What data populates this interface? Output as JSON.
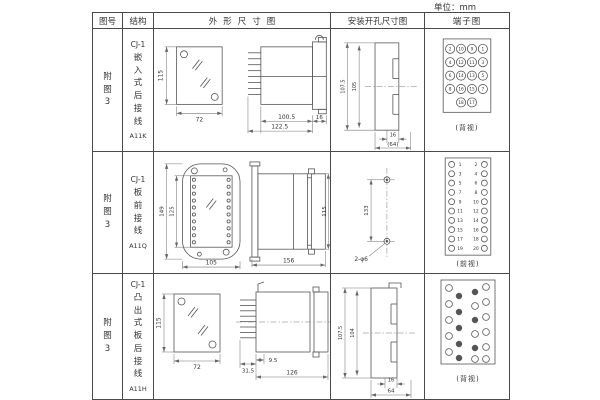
{
  "unit_label": "单位：mm",
  "headers": {
    "fig_no": "图号",
    "structure": "结构",
    "outline": "外形尺寸图",
    "mounting": "安装开孔尺寸图",
    "terminal": "端子图"
  },
  "rows": [
    {
      "fig_no": "附图3",
      "structure_title": "CJ-1",
      "structure_name": "嵌入式后接线",
      "model": "A11K",
      "outline": {
        "front_h": "115",
        "front_w": "72",
        "body_len": "100.5",
        "total_len": "122.5",
        "flange_w": "16"
      },
      "mounting": {
        "outer_h": "107.5",
        "inner_h": "105",
        "slot_w": "16",
        "width": "(64)"
      },
      "terminal": {
        "caption": "(背视)",
        "grid": [
          [
            "2",
            "10",
            "9",
            "1"
          ],
          [
            "4",
            "12",
            "11",
            "3"
          ],
          [
            "6",
            "14",
            "13",
            "5"
          ],
          [
            "8",
            "16",
            "15",
            "7"
          ]
        ],
        "bottom": [
          "18",
          "17"
        ]
      }
    },
    {
      "fig_no": "附图3",
      "structure_title": "CJ-1",
      "structure_name": "板前接线",
      "model": "A11Q",
      "outline": {
        "outer_h": "149",
        "inner_h": "125",
        "front_w": "105",
        "body_len": "156",
        "body_h": "115"
      },
      "mounting": {
        "hole_spacing": "133",
        "holes_label": "2-φ6"
      },
      "terminal": {
        "caption": "(前视)",
        "left": [
          "1",
          "3",
          "5",
          "7",
          "9",
          "11",
          "13",
          "15",
          "17",
          "19"
        ],
        "right": [
          "2",
          "4",
          "6",
          "8",
          "10",
          "12",
          "14",
          "16",
          "18",
          "20"
        ]
      }
    },
    {
      "fig_no": "附图3",
      "structure_title": "CJ-1",
      "structure_name": "凸出式板后接线",
      "model": "A11H",
      "outline": {
        "front_h": "115",
        "front_w": "72",
        "pin_len": "31.5",
        "offset": "9.5",
        "total_len": "126"
      },
      "mounting": {
        "outer_h": "107.5",
        "inner_h": "104",
        "slot_w": "16",
        "width": "64"
      },
      "terminal": {
        "caption": "(背视)"
      }
    }
  ]
}
